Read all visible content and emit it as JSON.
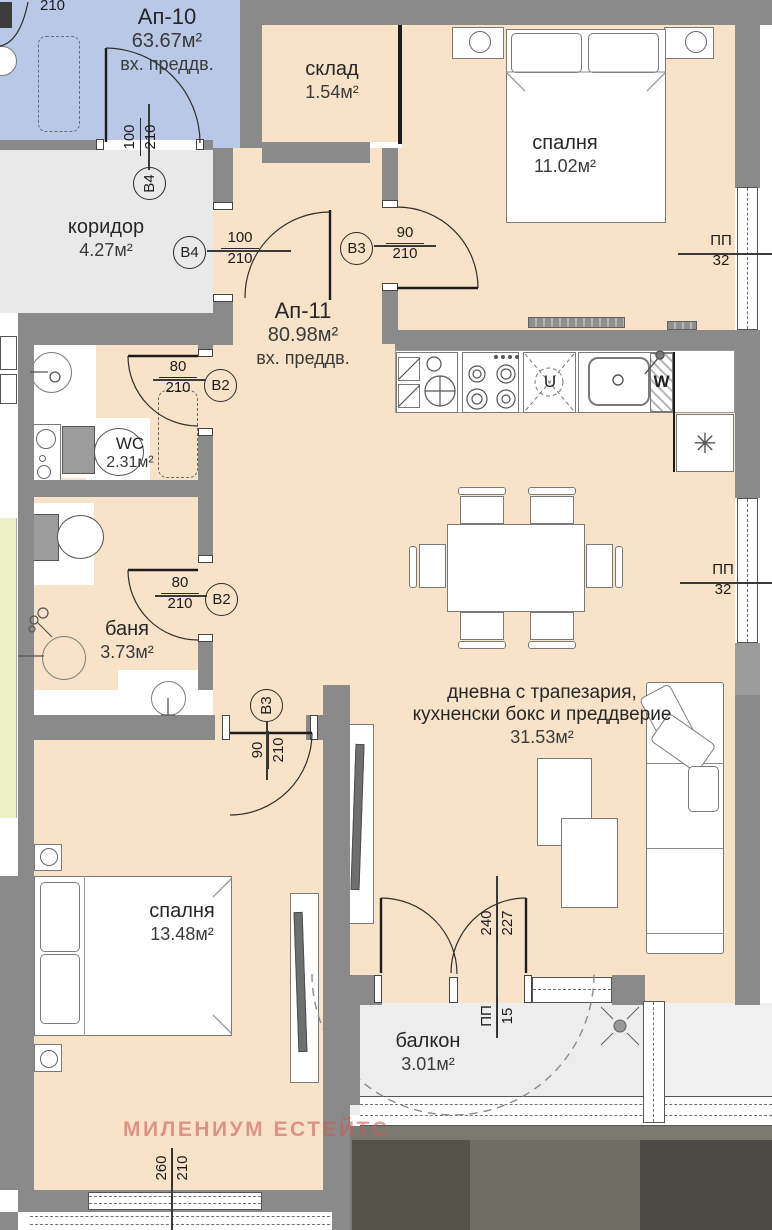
{
  "plan": {
    "watermark": "МИЛЕНИУМ ЕСТЕЙТС",
    "top_partial_dim": "210",
    "ap10": {
      "name": "Ап-10",
      "area": "63.67м²",
      "entry": "вх. преддв."
    },
    "ap11": {
      "name": "Ап-11",
      "area": "80.98м²",
      "entry": "вх. преддв."
    },
    "rooms": {
      "koridor": {
        "name": "коридор",
        "area": "4.27м²"
      },
      "sklad": {
        "name": "склад",
        "area": "1.54м²"
      },
      "bedroom_top": {
        "name": "спалня",
        "area": "11.02м²"
      },
      "wc": {
        "name": "WC",
        "area": "2.31м²"
      },
      "bath": {
        "name": "баня",
        "area": "3.73м²"
      },
      "living": {
        "line1": "дневна с трапезария,",
        "line2": "кухненски бокс и преддверие",
        "area": "31.53м²"
      },
      "bedroom_bottom": {
        "name": "спалня",
        "area": "13.48м²"
      },
      "balcony": {
        "name": "балкон",
        "area": "3.01м²"
      }
    },
    "doors": {
      "b4_ap10": {
        "tag": "В4",
        "w": "100",
        "h": "210"
      },
      "b4_ap11": {
        "tag": "В4",
        "w": "100",
        "h": "210"
      },
      "b3_kitchen": {
        "tag": "В3",
        "w": "90",
        "h": "210"
      },
      "b2_wc": {
        "tag": "В2",
        "w": "80",
        "h": "210"
      },
      "b2_bath": {
        "tag": "В2",
        "w": "80",
        "h": "210"
      },
      "b3_bedroom": {
        "tag": "В3",
        "w": "90",
        "h": "210"
      }
    },
    "windows": {
      "pp32_top": {
        "tag": "ПП",
        "num": "32"
      },
      "pp32_mid": {
        "tag": "ПП",
        "num": "32"
      },
      "pp15_balcony": {
        "tag": "ПП",
        "num": "15"
      },
      "balcony_door_dim": {
        "w": "240",
        "h": "227"
      },
      "bedroom_window_dim": {
        "w": "260",
        "h": "210"
      }
    },
    "kitchen": {
      "unit_u": "U",
      "unit_w": "W"
    },
    "symbols": {
      "vent": "✳"
    },
    "colors": {
      "floor": "#f8e3c9",
      "wall": "#8a8a8a",
      "neighbor": "#bac8e8",
      "common": "#e9e9e9",
      "watermark": "#c95a52"
    }
  }
}
